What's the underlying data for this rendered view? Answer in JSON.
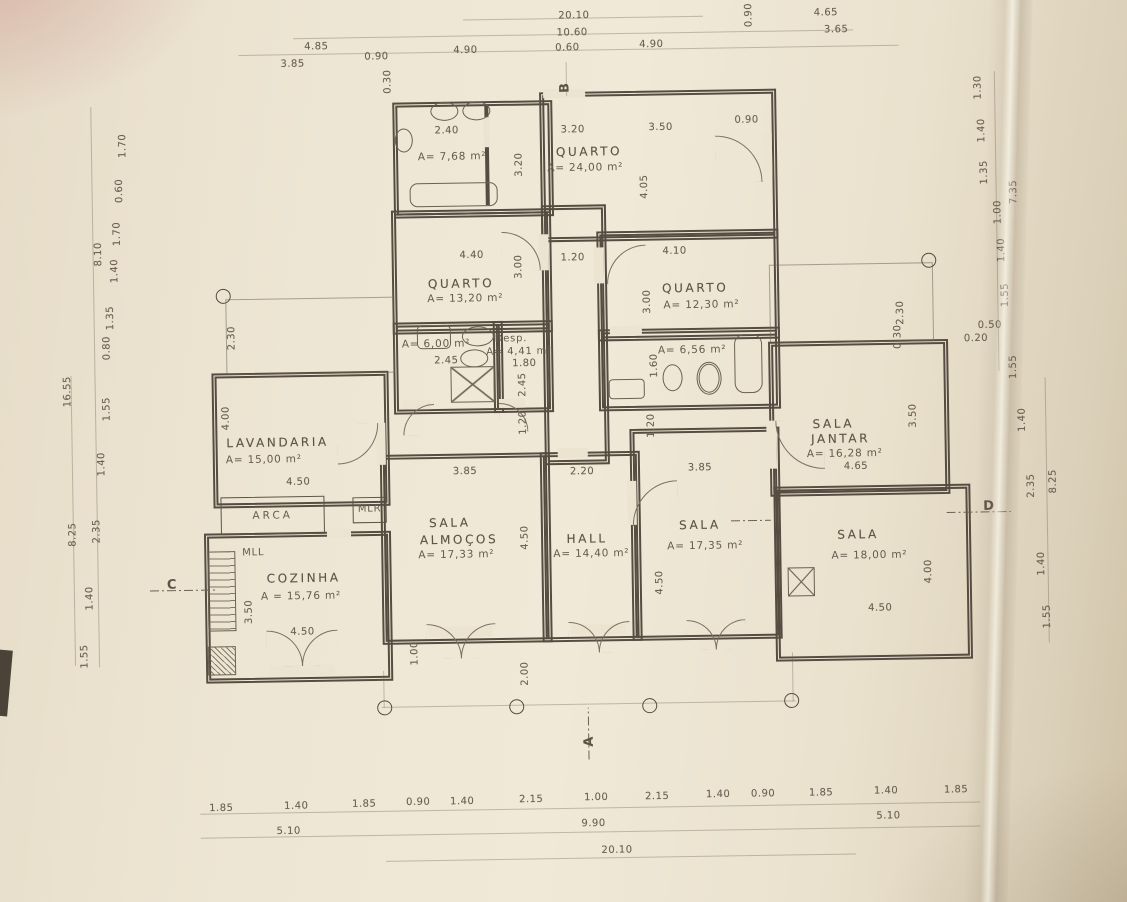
{
  "markers": {
    "top": "B",
    "bottom": "A",
    "left": "C",
    "right": "D"
  },
  "rooms": {
    "bath_top": {
      "area": "A= 7,68 m²"
    },
    "quarto_main": {
      "name": "QUARTO",
      "area": "A= 24,00 m²"
    },
    "quarto_mid": {
      "name": "QUARTO",
      "area": "A= 13,20 m²"
    },
    "quarto_right": {
      "name": "QUARTO",
      "area": "A= 12,30 m²"
    },
    "bath_mid": {
      "area": "A= 6,00 m²"
    },
    "despensa": {
      "name": "Desp.",
      "area": "A= 4,41 m²"
    },
    "bath_right": {
      "area": "A= 6,56 m²"
    },
    "lavandaria": {
      "name": "LAVANDARIA",
      "area": "A= 15,00 m²"
    },
    "cozinha": {
      "name": "COZINHA",
      "area": "A = 15,76 m²"
    },
    "sala_almocos": {
      "name_line1": "SALA",
      "name_line2": "ALMOÇOS",
      "area": "A= 17,33 m²"
    },
    "hall": {
      "name": "HALL",
      "area": "A= 14,40 m²"
    },
    "sala_center": {
      "name": "SALA",
      "area": "A= 17,35 m²"
    },
    "sala_jantar": {
      "name_line1": "SALA",
      "name_line2": "JANTAR",
      "area": "A= 16,28 m²"
    },
    "sala_right": {
      "name": "SALA",
      "area": "A= 18,00 m²"
    }
  },
  "closets": {
    "arca": "ARCA",
    "mlr": "MLR",
    "mll": "MLL"
  },
  "dims": {
    "top": {
      "d485": "4.85",
      "d385": "3.85",
      "d090a": "0.90",
      "d030": "0.30",
      "d2010": "20.10",
      "d1060": "10.60",
      "d060": "0.60",
      "d490a": "4.90",
      "d490b": "4.90",
      "d090v": "0.90",
      "d465": "4.65",
      "d365": "3.65"
    },
    "inner": {
      "d240": "2.40",
      "d320h": "3.20",
      "d320v": "3.20",
      "d350": "3.50",
      "d090": "0.90",
      "d405": "4.05",
      "d440": "4.40",
      "d300a": "3.00",
      "d120": "1.20",
      "d410": "4.10",
      "d300b": "3.00",
      "d245h": "2.45",
      "d180": "1.80",
      "d245v": "2.45",
      "d160": "1.60",
      "d120va": "1.20",
      "d120vb": "1.20",
      "d230": "2.30",
      "d400": "4.00",
      "d450lav": "4.50",
      "d350coz": "3.50",
      "d450coz": "4.50",
      "d385a": "3.85",
      "d220": "2.20",
      "d385b": "3.85",
      "d450sa": "4.50",
      "d450sc": "4.50",
      "d100": "1.00",
      "d200": "2.00",
      "d465sj": "4.65",
      "d350sj": "3.50",
      "d230r": "2.30",
      "d030r": "0.30",
      "d050": "0.50",
      "d020": "0.20",
      "d450sr": "4.50",
      "d400r": "4.00"
    },
    "left": {
      "d170a": "1.70",
      "d060": "0.60",
      "d170b": "1.70",
      "d810": "8.10",
      "d140a": "1.40",
      "d135": "1.35",
      "d080": "0.80",
      "d1655": "16.55",
      "d155a": "1.55",
      "d140b": "1.40",
      "d235": "2.35",
      "d825": "8.25",
      "d140c": "1.40",
      "d155b": "1.55"
    },
    "right": {
      "d130": "1.30",
      "d140a": "1.40",
      "d135": "1.35",
      "d735": "7.35",
      "d100": "1.00",
      "d140b": "1.40",
      "d155a": "1.55",
      "d155b": "1.55",
      "d140c": "1.40",
      "d235": "2.35",
      "d825": "8.25",
      "d140d": "1.40",
      "d155c": "1.55"
    },
    "bottom": {
      "d185a": "1.85",
      "d140a": "1.40",
      "d185b": "1.85",
      "d090a": "0.90",
      "d140b": "1.40",
      "d215a": "2.15",
      "d100": "1.00",
      "d215b": "2.15",
      "d140c": "1.40",
      "d090b": "0.90",
      "d185c": "1.85",
      "d140d": "1.40",
      "d185d": "1.85",
      "d510a": "5.10",
      "d990": "9.90",
      "d510b": "5.10",
      "d2010": "20.10"
    }
  }
}
